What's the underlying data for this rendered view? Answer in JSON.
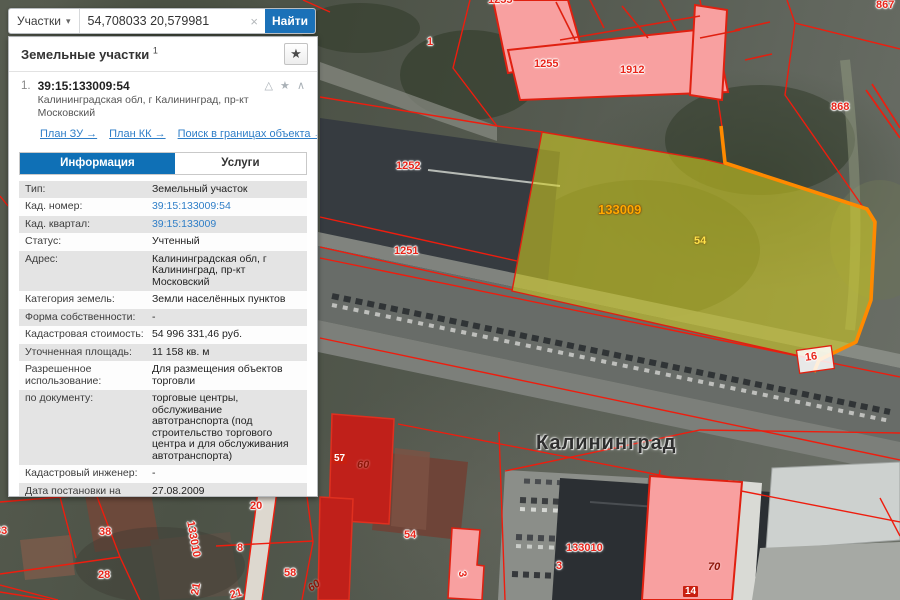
{
  "search": {
    "category": "Участки",
    "caret_icon": "▾",
    "value": "54,708033 20,579981",
    "clear_icon": "×",
    "button": "Найти"
  },
  "panel": {
    "title": "Земельные участки",
    "title_sup": "1",
    "favorite_icon": "★",
    "item": {
      "index": "1.",
      "cadastral": "39:15:133009:54",
      "address": "Калининградская обл, г Калининград, пр-кт Московский",
      "icons": {
        "warning": "△",
        "favorite": "★",
        "collapse": "∧"
      },
      "links": [
        "План ЗУ →",
        "План КК →",
        "Поиск в границах объекта →"
      ]
    },
    "tabs": [
      {
        "label": "Информация"
      },
      {
        "label": "Услуги"
      }
    ],
    "rows": [
      {
        "label": "Тип:",
        "value": "Земельный участок"
      },
      {
        "label": "Кад. номер:",
        "value": "39:15:133009:54"
      },
      {
        "label": "Кад. квартал:",
        "value": "39:15:133009"
      },
      {
        "label": "Статус:",
        "value": "Учтенный"
      },
      {
        "label": "Адрес:",
        "value": "Калининградская обл, г Калининград, пр-кт Московский"
      },
      {
        "label": "Категория земель:",
        "value": "Земли населённых пунктов"
      },
      {
        "label": "Форма собственности:",
        "value": "-"
      },
      {
        "label": "Кадастровая стоимость:",
        "value": "54 996 331,46 руб."
      },
      {
        "label": "Уточненная площадь:",
        "value": "11 158 кв. м"
      },
      {
        "label": "Разрешенное использование:",
        "value": "Для размещения объектов торговли"
      },
      {
        "label": "по документу:",
        "value": "торговые центры, обслуживание автотранспорта (под строительство торгового центра и для обслуживания автотранспорта)"
      },
      {
        "label": "Кадастровый инженер:",
        "value": "-"
      },
      {
        "label": "Дата постановки на учет:",
        "value": "27.08.2009"
      },
      {
        "label": "Дата изменения сведений в ГКН:",
        "value": "27.10.2015"
      },
      {
        "label": "Дата выгрузки сведений из ГКН:",
        "value": "28.10.2015"
      }
    ]
  },
  "map": {
    "city": "Калининград",
    "highlight_colors": {
      "parcel_fill": "#d7d21e",
      "parcel_border": "#ff8a00",
      "cadastral_line": "#ee1d0e"
    },
    "labels": [
      {
        "text": "1255"
      },
      {
        "text": "1912"
      },
      {
        "text": "868"
      },
      {
        "text": "867"
      },
      {
        "text": "1"
      },
      {
        "text": "1252"
      },
      {
        "text": "1251"
      },
      {
        "text": "133009"
      },
      {
        "text": "54"
      },
      {
        "text": "16"
      },
      {
        "text": "57"
      },
      {
        "text": "60"
      },
      {
        "text": "54"
      },
      {
        "text": "133010"
      },
      {
        "text": "3"
      },
      {
        "text": "70"
      },
      {
        "text": "14"
      },
      {
        "text": "38"
      },
      {
        "text": "28"
      },
      {
        "text": "33"
      },
      {
        "text": "20"
      },
      {
        "text": "8"
      },
      {
        "text": "58"
      },
      {
        "text": "60"
      },
      {
        "text": "21"
      },
      {
        "text": "21"
      },
      {
        "text": "133010"
      },
      {
        "text": "1255"
      },
      {
        "text": "3"
      }
    ]
  }
}
